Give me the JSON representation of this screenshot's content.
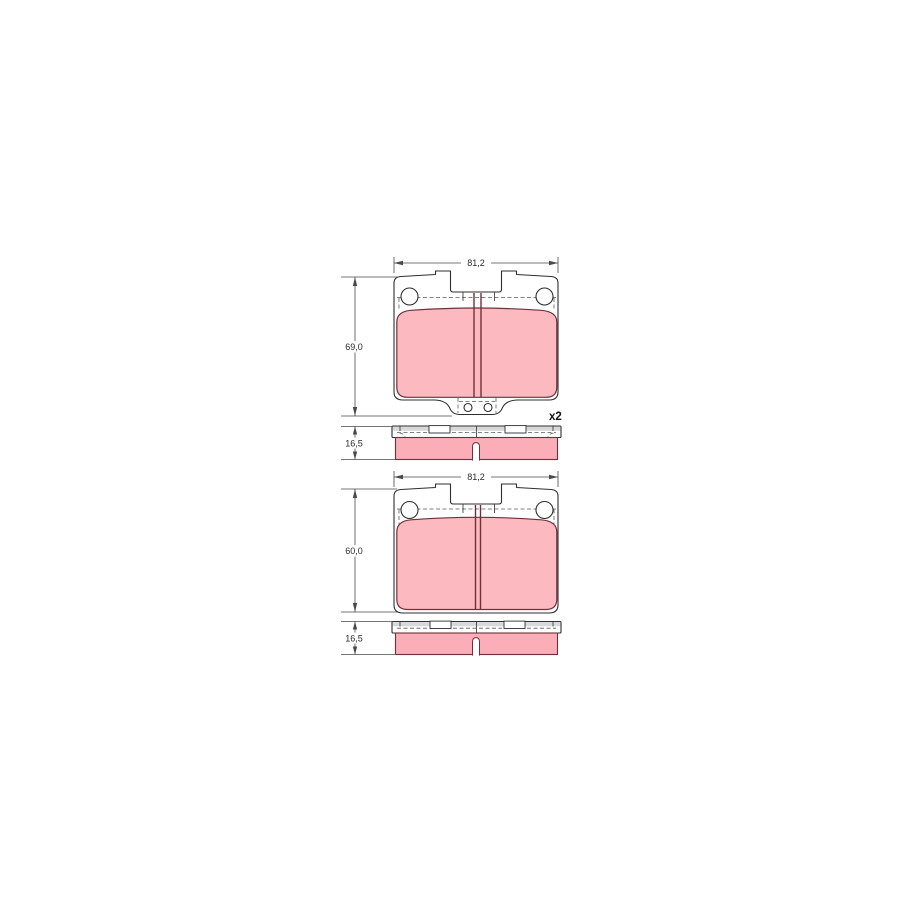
{
  "page": {
    "background": "#ffffff"
  },
  "drawing": {
    "colors": {
      "page_bg": "#ffffff",
      "plate_line": "#2e2e33",
      "pad_fill": "#fdb9c0",
      "side_pad_fill": "#fbadb8",
      "pad_stroke": "#713038",
      "plate_band": "#d8d8d8",
      "hidden_line": "#5a5a5a",
      "dim_line": "#4a4a4a",
      "dim_text": "#2b2b2b"
    },
    "views": [
      {
        "id": "pad1-front",
        "type": "front-view",
        "width_label": "81,2",
        "height_label": "69,0",
        "quantity_label": "x2"
      },
      {
        "id": "pad1-side",
        "type": "side-view",
        "thickness_label": "16,5"
      },
      {
        "id": "pad2-front",
        "type": "front-view",
        "width_label": "81,2",
        "height_label": "60,0"
      },
      {
        "id": "pad2-side",
        "type": "side-view",
        "thickness_label": "16,5"
      }
    ]
  }
}
